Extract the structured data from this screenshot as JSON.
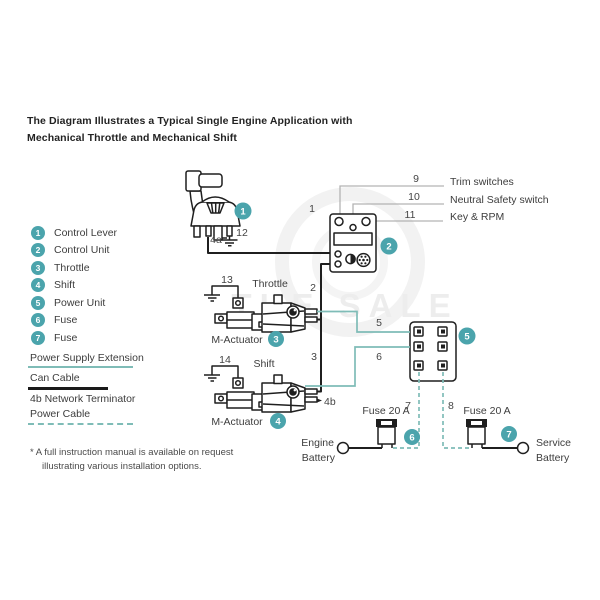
{
  "title": {
    "line1": "The Diagram Illustrates a Typical Single Engine Application with",
    "line2": "Mechanical Throttle and Mechanical Shift"
  },
  "legend_items": [
    {
      "num": "1",
      "label": "Control Lever"
    },
    {
      "num": "2",
      "label": "Control Unit"
    },
    {
      "num": "3",
      "label": "Throttle"
    },
    {
      "num": "4",
      "label": "Shift"
    },
    {
      "num": "5",
      "label": "Power Unit"
    },
    {
      "num": "6",
      "label": "Fuse"
    },
    {
      "num": "7",
      "label": "Fuse"
    }
  ],
  "line_legend": [
    {
      "label": "Power Supply Extension",
      "style": "teal-solid"
    },
    {
      "label": "Can Cable",
      "style": "black-solid"
    },
    {
      "label": "4b Network Terminator",
      "style": "none"
    },
    {
      "label": "Power Cable",
      "style": "teal-dashed"
    }
  ],
  "callouts": [
    {
      "num": "9",
      "label": "Trim switches"
    },
    {
      "num": "10",
      "label": "Neutral Safety switch"
    },
    {
      "num": "11",
      "label": "Key & RPM"
    }
  ],
  "labels": {
    "throttle": "Throttle",
    "shift": "Shift",
    "m_actuator": "M-Actuator",
    "fuse_rating": "Fuse 20 A",
    "engine_battery_1": "Engine",
    "engine_battery_2": "Battery",
    "service_battery_1": "Service",
    "service_battery_2": "Battery"
  },
  "badges": {
    "b1": "1",
    "b2": "2",
    "b3": "3",
    "b4": "4",
    "b5": "5",
    "b6": "6",
    "b7": "7"
  },
  "wires": {
    "w1": "1",
    "w2": "2",
    "w3": "3",
    "w5": "5",
    "w6": "6",
    "w7": "7",
    "w8": "8",
    "w12": "12",
    "w13": "13",
    "w14": "14",
    "t4a": "4a",
    "t4b": "4b"
  },
  "footnote": {
    "line1": "* A full instruction manual is available on request",
    "line2": "illustrating various installation options."
  },
  "watermark": "THE SALE",
  "colors": {
    "accent": "#4BA4AC",
    "wire_teal": "#7FBCB7",
    "wire_black": "#1F1F1F",
    "callout_gray": "#B3B3B3"
  }
}
